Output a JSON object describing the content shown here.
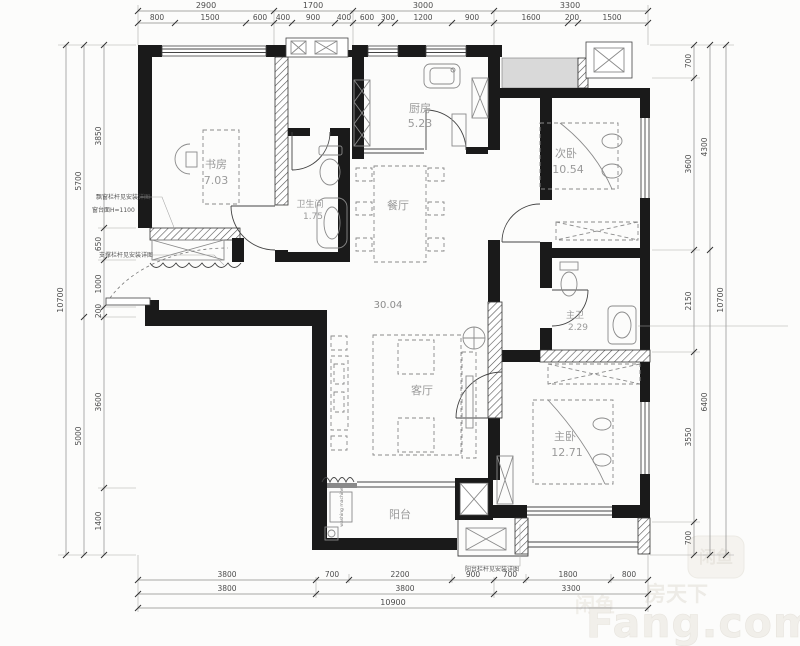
{
  "rooms": {
    "study": {
      "name": "书房",
      "area": "7.03"
    },
    "bath": {
      "name": "卫生间",
      "area": "1.75"
    },
    "kitchen": {
      "name": "厨房",
      "area": "5.23"
    },
    "dining": {
      "name": "餐厅"
    },
    "second_bedroom": {
      "name": "次卧",
      "area": "10.54"
    },
    "living": {
      "name": "客厅"
    },
    "living_dining_total_area": "30.04",
    "master_bath": {
      "name": "主卫",
      "area": "2.29"
    },
    "master_bedroom": {
      "name": "主卧",
      "area": "12.71"
    },
    "balcony": {
      "name": "阳台"
    }
  },
  "dimensions": {
    "top_groups": [
      "2900",
      "1700",
      "3000",
      "3300"
    ],
    "top_detail": [
      "800",
      "1500",
      "600",
      "400",
      "900",
      "400",
      "600",
      "300",
      "1200",
      "900",
      "1600",
      "200",
      "1500"
    ],
    "bottom_detail": [
      "3800",
      "700",
      "2200",
      "900",
      "700",
      "1800",
      "800"
    ],
    "bottom_groups": [
      "3800",
      "3800",
      "3300"
    ],
    "bottom_total": "10900",
    "left_detail": [
      "3850",
      "650",
      "1000",
      "200",
      "3600",
      "1400"
    ],
    "left_groups": [
      "5700",
      "5000"
    ],
    "left_total": "10700",
    "right_detail": [
      "700",
      "3600",
      "2150",
      "3550",
      "700"
    ],
    "right_groups": [
      "4300",
      "6400"
    ],
    "right_total": "10700"
  },
  "annotations": {
    "bay_note_1": "飘窗栏杆见安装详图",
    "bay_note_2": "窗台面H=1100",
    "entry_note": "支撑栏杆见安装详图",
    "balcony_note": "阳台栏杆见安装详图",
    "washing_machine": "washing machine"
  },
  "watermark": {
    "logo": "闲鱼",
    "logo_left": "闲鱼",
    "brand_cn": "房天下",
    "brand_en": "Fang.com"
  },
  "colors": {
    "wall": "#1a1a1a",
    "dim_text": "#4d4d4d",
    "room_text": "#9a9a9a",
    "watermark": "#f0eeea"
  }
}
